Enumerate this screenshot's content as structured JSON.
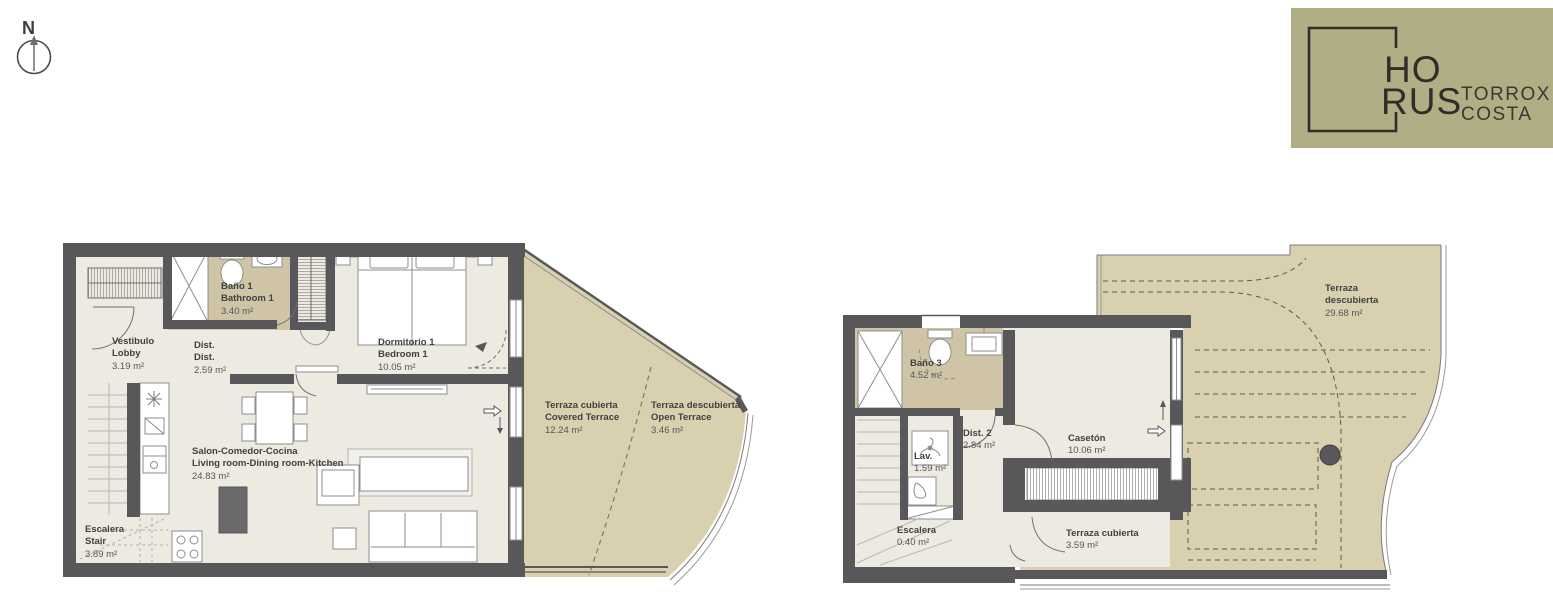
{
  "compass": {
    "label": "N"
  },
  "logo": {
    "brand_line1": "HO",
    "brand_line2": "RUS",
    "project_line1": "TORROX",
    "project_line2": "COSTA",
    "bg_color": "#b1ad85",
    "ink_color": "#2f2e29"
  },
  "colors": {
    "wall": "#58585a",
    "interior_floor": "#edeae2",
    "wet_floor": "#cfc5a6",
    "terrace_floor": "#d8d0ae",
    "furniture_stroke": "#8e8e8c"
  },
  "plans": {
    "left": {
      "rooms": [
        {
          "id": "vestibulo",
          "lines": [
            "Vestibulo",
            "Lobby"
          ],
          "area": "3.19 m²"
        },
        {
          "id": "dist-1",
          "lines": [
            "Dist.",
            "Dist."
          ],
          "area": "2.59 m²"
        },
        {
          "id": "bano-1",
          "lines": [
            "Baño 1",
            "Bathroom 1"
          ],
          "area": "3.40 m²"
        },
        {
          "id": "dormitorio-1",
          "lines": [
            "Dormitorio 1",
            "Bedroom 1"
          ],
          "area": "10.05 m²"
        },
        {
          "id": "salon",
          "lines": [
            "Salon-Comedor-Cocina",
            "Living room-Dining room-Kitchen"
          ],
          "area": "24.83 m²"
        },
        {
          "id": "escalera",
          "lines": [
            "Escalera",
            "Stair"
          ],
          "area": "3.89 m²"
        },
        {
          "id": "terraza-cubierta",
          "lines": [
            "Terraza cubierta",
            "Covered Terrace"
          ],
          "area": "12.24 m²"
        },
        {
          "id": "terraza-descubierta",
          "lines": [
            "Terraza descubierta",
            "Open Terrace"
          ],
          "area": "3.46 m²"
        }
      ]
    },
    "right": {
      "rooms": [
        {
          "id": "bano-3",
          "lines": [
            "Baño 3"
          ],
          "area": "4.52 m²"
        },
        {
          "id": "lav",
          "lines": [
            "Lav."
          ],
          "area": "1.59 m²"
        },
        {
          "id": "dist-2",
          "lines": [
            "Dist. 2"
          ],
          "area": "2.84 m²"
        },
        {
          "id": "caseton",
          "lines": [
            "Casetón"
          ],
          "area": "10.06 m²"
        },
        {
          "id": "escalera-2",
          "lines": [
            "Escalera"
          ],
          "area": "0.40 m²"
        },
        {
          "id": "terraza-cubierta-2",
          "lines": [
            "Terraza cubierta"
          ],
          "area": "3.59 m²"
        },
        {
          "id": "terraza-descubierta-2",
          "lines": [
            "Terraza",
            "descubierta"
          ],
          "area": "29.68 m²"
        }
      ]
    }
  }
}
